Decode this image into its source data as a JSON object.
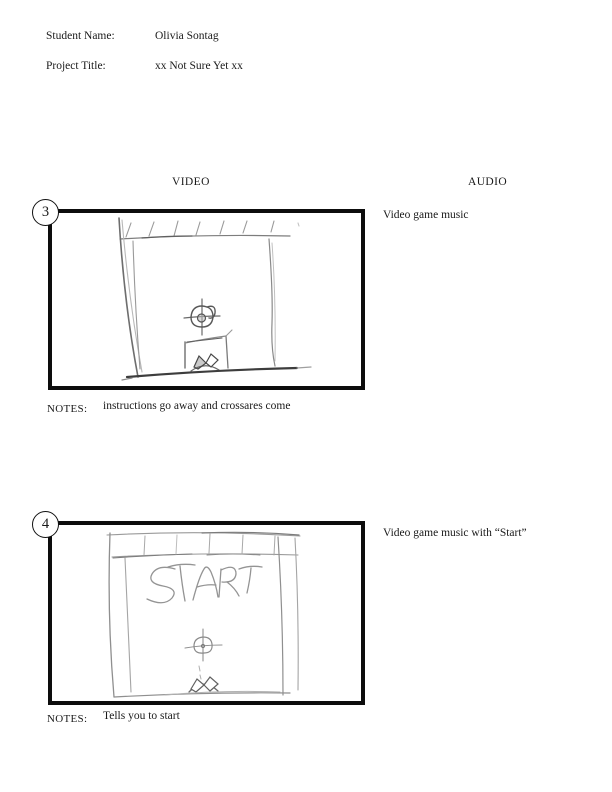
{
  "header": {
    "student_name_label": "Student Name:",
    "student_name_value": "Olivia Sontag",
    "project_title_label": "Project Title:",
    "project_title_value": "xx Not Sure Yet xx"
  },
  "columns": {
    "video": "VIDEO",
    "audio": "AUDIO"
  },
  "frames": [
    {
      "number": "3",
      "audio": "Video game music",
      "notes_label": "NOTES:",
      "notes": "instructions go away and crossares come",
      "sketch_text": ""
    },
    {
      "number": "4",
      "audio": "Video game music with “Start”",
      "notes_label": "NOTES:",
      "notes": "Tells you to start",
      "sketch_text": "START"
    }
  ],
  "colors": {
    "ink": "#1a1a1a",
    "frame_border": "#0d0d0d",
    "pencil_light": "#b0b0b0",
    "pencil_mid": "#8f8f8f",
    "pencil_dark": "#5c5c5c",
    "background": "#ffffff"
  }
}
